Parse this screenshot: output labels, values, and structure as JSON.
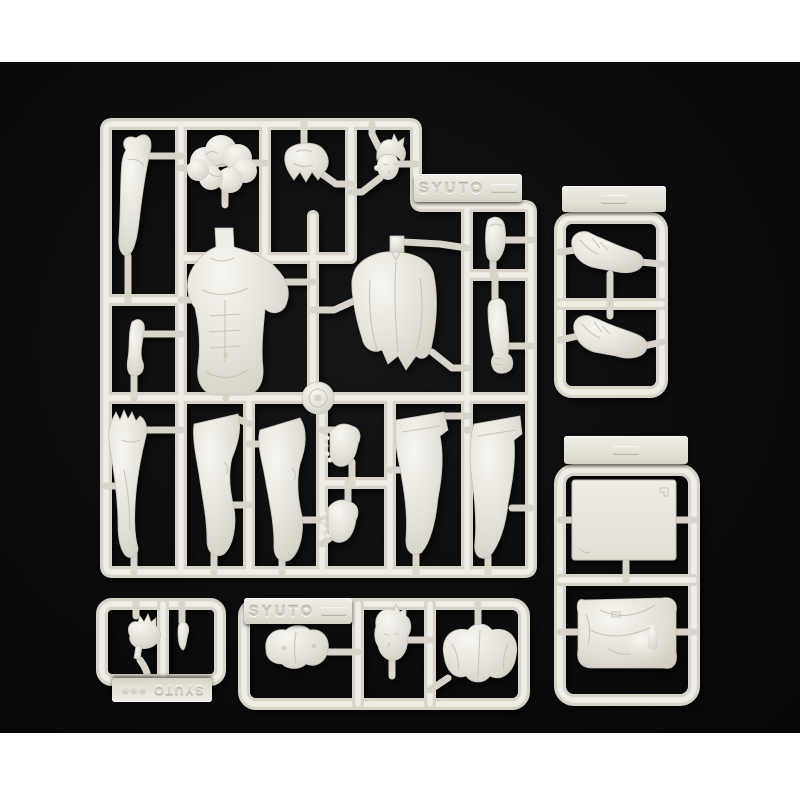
{
  "photo": {
    "margin_color": "#ffffff",
    "background_color": "#0b0b0c",
    "plastic_base": "#e8e5dd",
    "plastic_highlight": "#f3f1eb",
    "plastic_shadow": "#c9c5ba"
  },
  "tags": {
    "main": "SYUTO",
    "bottom_middle": "SYUTO",
    "bottom_left": "SYUTO",
    "bottom_left_marks": "✳✳✳"
  },
  "parts": {
    "main_sprue": [
      "bent-arm",
      "wavy-hair",
      "hair-fringe",
      "head",
      "small-foot",
      "muscular-torso-front",
      "draped-shirt-back",
      "upper-arm-segment",
      "forearm-with-fist",
      "arm-with-open-hand",
      "thigh-leg-a",
      "thigh-leg-b",
      "foot-a",
      "foot-b",
      "flared-leg-c",
      "flared-leg-d",
      "sprue-gate-disc"
    ],
    "top_right_sprue": [
      "boot-upper",
      "boot-lower"
    ],
    "bottom_right_sprue": [
      "flat-base-plate",
      "folded-jacket"
    ],
    "bottom_left_sprue": [
      "open-hand",
      "small-grip-part"
    ],
    "bottom_middle_sprue": [
      "chest-piece",
      "spiky-hair-head",
      "pelvis-piece"
    ]
  }
}
